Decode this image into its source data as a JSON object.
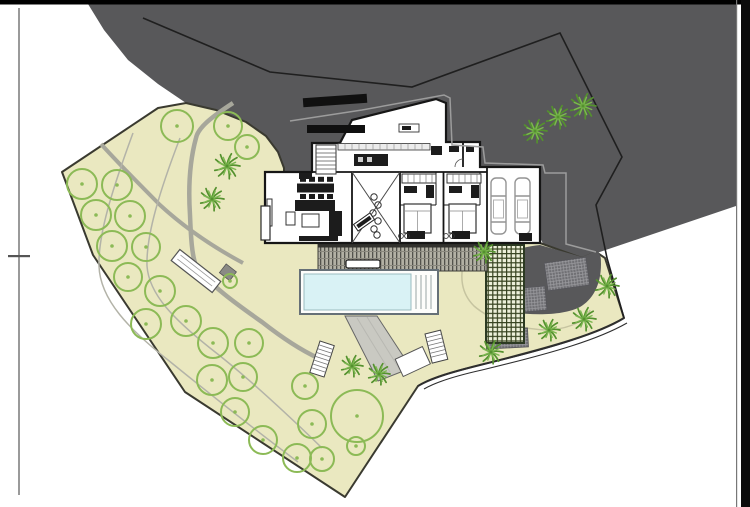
{
  "sheet": {
    "background": "#ffffff",
    "top_border_color": "#000000",
    "right_border_color": "#0b0b0b",
    "frame_line_color": "#9a9a9a",
    "tick_color": "#555555"
  },
  "colors": {
    "terrain": "#58585a",
    "site_fill": "#eae8c0",
    "site_border": "#3a3a30",
    "boundary_line": "#1f1f1f",
    "road_line": "#2e2e2e",
    "tree_stroke": "#8cba56",
    "palm_dark": "#54912e",
    "palm_light": "#7cb850",
    "pool_water": "#d9f2f5",
    "pool_frame": "#667077",
    "deck_base": "#b2b0a4",
    "deck_stripe": "#52524c",
    "pergola_bg": "#edf0da",
    "pergola_grid": "#36421f",
    "hatch_bg": "#707074",
    "hatch_line": "#9c9ca0",
    "ramp_fill": "#c9c9c2",
    "path_stroke": "#a7a79b",
    "row_line": "#b3b3a8",
    "bed_curve": "#c6c4a0",
    "wall": "#161616",
    "furniture": "#1c1c1c",
    "light_outline": "#9c9c9c",
    "car_outline": "#949494"
  },
  "plan": {
    "trees": [
      {
        "x": 177,
        "y": 126,
        "r": 16
      },
      {
        "x": 228,
        "y": 126,
        "r": 14
      },
      {
        "x": 247,
        "y": 147,
        "r": 12
      },
      {
        "x": 82,
        "y": 184,
        "r": 15
      },
      {
        "x": 117,
        "y": 185,
        "r": 15
      },
      {
        "x": 96,
        "y": 215,
        "r": 15
      },
      {
        "x": 130,
        "y": 216,
        "r": 15
      },
      {
        "x": 112,
        "y": 246,
        "r": 15
      },
      {
        "x": 146,
        "y": 247,
        "r": 14
      },
      {
        "x": 128,
        "y": 277,
        "r": 14
      },
      {
        "x": 160,
        "y": 291,
        "r": 15
      },
      {
        "x": 146,
        "y": 324,
        "r": 15
      },
      {
        "x": 186,
        "y": 321,
        "r": 15
      },
      {
        "x": 213,
        "y": 343,
        "r": 15
      },
      {
        "x": 249,
        "y": 343,
        "r": 14
      },
      {
        "x": 212,
        "y": 380,
        "r": 15
      },
      {
        "x": 243,
        "y": 377,
        "r": 14
      },
      {
        "x": 305,
        "y": 386,
        "r": 13
      },
      {
        "x": 235,
        "y": 412,
        "r": 14
      },
      {
        "x": 263,
        "y": 440,
        "r": 14
      },
      {
        "x": 297,
        "y": 458,
        "r": 14
      },
      {
        "x": 322,
        "y": 459,
        "r": 12
      },
      {
        "x": 312,
        "y": 424,
        "r": 14
      },
      {
        "x": 357,
        "y": 416,
        "r": 26
      },
      {
        "x": 356,
        "y": 446,
        "r": 9
      },
      {
        "x": 230,
        "y": 281,
        "r": 7
      }
    ],
    "palms": [
      {
        "x": 227,
        "y": 166,
        "r": 13
      },
      {
        "x": 212,
        "y": 199,
        "r": 12
      },
      {
        "x": 535,
        "y": 131,
        "r": 12
      },
      {
        "x": 558,
        "y": 117,
        "r": 12
      },
      {
        "x": 583,
        "y": 106,
        "r": 13
      },
      {
        "x": 484,
        "y": 252,
        "r": 11
      },
      {
        "x": 607,
        "y": 286,
        "r": 12
      },
      {
        "x": 584,
        "y": 319,
        "r": 12
      },
      {
        "x": 549,
        "y": 330,
        "r": 11
      },
      {
        "x": 491,
        "y": 352,
        "r": 12
      },
      {
        "x": 352,
        "y": 366,
        "r": 11
      },
      {
        "x": 379,
        "y": 374,
        "r": 11
      }
    ],
    "driveway_patches": [
      {
        "x": 546,
        "y": 260,
        "w": 42,
        "h": 28,
        "rot": -8
      },
      {
        "x": 500,
        "y": 288,
        "w": 46,
        "h": 24,
        "rot": -5
      },
      {
        "x": 486,
        "y": 329,
        "w": 42,
        "h": 19,
        "rot": -3
      }
    ],
    "pool": {
      "x": 300,
      "y": 270,
      "w": 138,
      "h": 44
    }
  }
}
